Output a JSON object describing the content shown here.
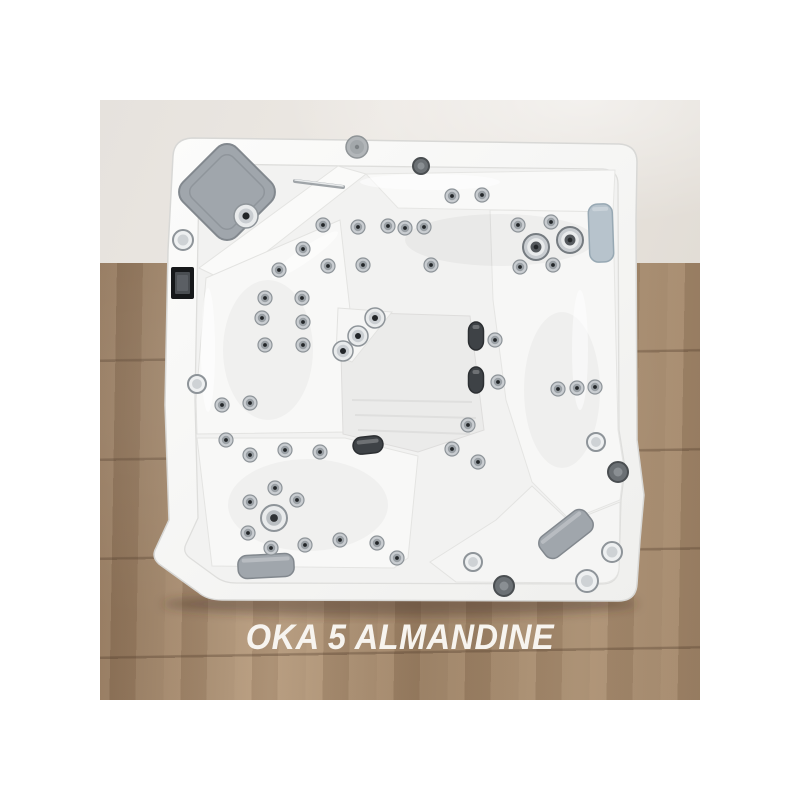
{
  "page": {
    "background_color": "#ffffff",
    "caption": "OKA 5 ALMANDINE",
    "caption_color": "#f7f4ef"
  },
  "scene": {
    "backdrop": {
      "wall_color": "#e9e5e0",
      "floor_wood_color": "#a1866a",
      "floor_wood_dark": "#8a6f55",
      "floor_wood_light": "#b59a7d"
    },
    "palette": {
      "shell": "#f7f7f6",
      "shell_edge": "#d8d8d6",
      "basin": "#f2f2f1",
      "chrome": "#c9cdd1",
      "chrome_light": "#e9ebec",
      "chrome_dark": "#8e9499",
      "jet_mid": "#9aa0a5",
      "jet_core": "#232629",
      "pillow_gray": "#a0a6ac",
      "pillow_edge": "#82888e",
      "headrest_blue": "#b7c3cc",
      "headrest_edge": "#97a8b3",
      "dark_pillow": "#3e4246",
      "panel_black": "#16181a",
      "panel_screen": "#4a4e52",
      "speaker_gray": "#b2b6b9"
    },
    "fixtures": {
      "small_jets": [
        [
          165,
          198
        ],
        [
          162,
          218
        ],
        [
          165,
          245
        ],
        [
          202,
          198
        ],
        [
          203,
          222
        ],
        [
          203,
          245
        ],
        [
          179,
          170
        ],
        [
          203,
          149
        ],
        [
          223,
          125
        ],
        [
          258,
          127
        ],
        [
          288,
          126
        ],
        [
          305,
          128
        ],
        [
          324,
          127
        ],
        [
          228,
          166
        ],
        [
          263,
          165
        ],
        [
          331,
          165
        ],
        [
          352,
          96
        ],
        [
          382,
          95
        ],
        [
          418,
          125
        ],
        [
          451,
          122
        ],
        [
          420,
          167
        ],
        [
          453,
          165
        ],
        [
          395,
          240
        ],
        [
          398,
          282
        ],
        [
          458,
          289
        ],
        [
          477,
          288
        ],
        [
          495,
          287
        ],
        [
          368,
          325
        ],
        [
          352,
          349
        ],
        [
          378,
          362
        ],
        [
          122,
          305
        ],
        [
          126,
          340
        ],
        [
          150,
          303
        ],
        [
          150,
          355
        ],
        [
          185,
          350
        ],
        [
          220,
          352
        ],
        [
          175,
          388
        ],
        [
          150,
          402
        ],
        [
          197,
          400
        ],
        [
          148,
          433
        ],
        [
          171,
          448
        ],
        [
          205,
          445
        ],
        [
          240,
          440
        ],
        [
          277,
          443
        ],
        [
          297,
          458
        ]
      ],
      "medium_jets": [
        [
          146,
          116,
          12
        ],
        [
          275,
          218,
          10
        ],
        [
          258,
          236,
          10
        ],
        [
          243,
          251,
          10
        ]
      ],
      "large_jets": [
        [
          436,
          147,
          13
        ],
        [
          470,
          140,
          13
        ]
      ],
      "drain_jet": [
        174,
        418,
        13
      ],
      "rim_round_chrome": [
        [
          83,
          140,
          10
        ],
        [
          97,
          284,
          9
        ],
        [
          496,
          342,
          9
        ],
        [
          512,
          452,
          10
        ],
        [
          487,
          481,
          11
        ],
        [
          373,
          462,
          9
        ]
      ],
      "rim_round_dark": [
        [
          321,
          66,
          8
        ],
        [
          518,
          372,
          10
        ],
        [
          404,
          486,
          10
        ]
      ],
      "rim_speaker": [
        [
          257,
          47,
          11
        ]
      ],
      "control_panel": {
        "x": 71,
        "y": 167,
        "w": 23,
        "h": 32
      },
      "grab_bar": {
        "x1": 195,
        "y1": 81,
        "x2": 243,
        "y2": 87
      }
    },
    "pillows": {
      "corner_diamond": {
        "cx": 127,
        "cy": 92,
        "size": 76,
        "rot": 45
      },
      "bottom_left": {
        "cx": 166,
        "cy": 466,
        "w": 56,
        "h": 23,
        "rot": -3
      },
      "bottom_right": {
        "cx": 466,
        "cy": 434,
        "w": 58,
        "h": 26,
        "rot": -38
      },
      "right_headrest": {
        "cx": 501,
        "cy": 133,
        "w": 24,
        "h": 58,
        "rot": -2
      },
      "dark_roll_upper": {
        "cx": 376,
        "cy": 236,
        "w": 15,
        "h": 28,
        "rot": 0
      },
      "dark_roll_lower": {
        "cx": 376,
        "cy": 280,
        "w": 15,
        "h": 26,
        "rot": 0
      },
      "dark_bottom_pillow": {
        "cx": 268,
        "cy": 345,
        "w": 30,
        "h": 17,
        "rot": -6
      }
    }
  }
}
